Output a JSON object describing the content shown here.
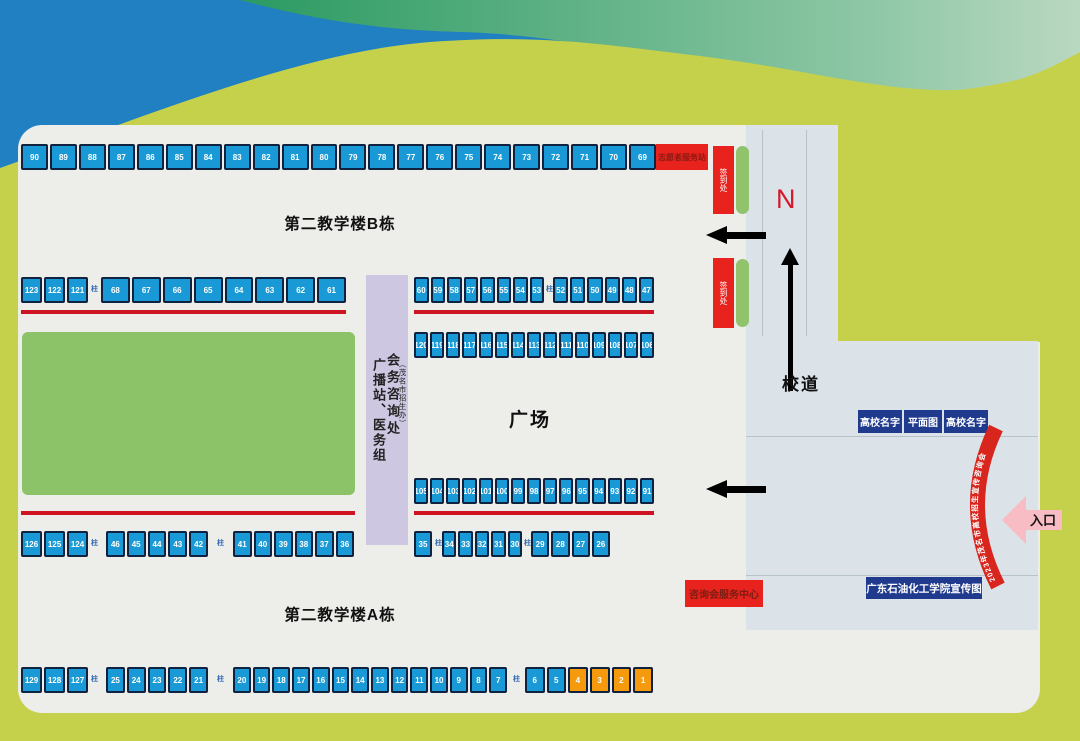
{
  "labels": {
    "building_b": "第二教学楼B栋",
    "building_a": "第二教学楼A栋",
    "plaza": "广场",
    "road": "校道",
    "north": "N",
    "volunteer_station": "志愿者服务站",
    "service_center": "咨询会服务中心",
    "entrance": "入口",
    "banner": "广东石油化工学院宣传图",
    "uni_name": "高校名字",
    "site_map": "平面图",
    "broadcast_medical": "广播站、医务组",
    "conference_info": "会务咨询处",
    "admissions_office": "（茂名市招生办）",
    "checkin": "签到处",
    "pillar": "柱",
    "arc_banner": "2023年茂名市高校招生宣传咨询会"
  },
  "booths": {
    "row_a": [
      90,
      89,
      88,
      87,
      86,
      85,
      84,
      83,
      82,
      81,
      80,
      79,
      78,
      77,
      76,
      75,
      74,
      73,
      72,
      71,
      70,
      69
    ],
    "row_b1": [
      123,
      122,
      121
    ],
    "row_b2": [
      68,
      67,
      66,
      65,
      64,
      63,
      62,
      61
    ],
    "row_b3": [
      60,
      59,
      58,
      57,
      56,
      55,
      54,
      53
    ],
    "row_b4": [
      52,
      51,
      50,
      49,
      48,
      47
    ],
    "row_c": [
      120,
      119,
      118,
      117,
      116,
      115,
      114,
      113,
      112,
      111,
      110,
      109,
      108,
      107,
      106
    ],
    "row_d": [
      105,
      104,
      103,
      102,
      101,
      100,
      99,
      98,
      97,
      96,
      95,
      94,
      93,
      92,
      91
    ],
    "row_e1": [
      126,
      125,
      124
    ],
    "row_e2": [
      46,
      45,
      44,
      43,
      42
    ],
    "row_e3": [
      41,
      40,
      39,
      38,
      37,
      36
    ],
    "row_e4": [
      35
    ],
    "row_e5": [
      34,
      33,
      32,
      31,
      30
    ],
    "row_e6": [
      29,
      28,
      27,
      26
    ],
    "row_f1": [
      129,
      128,
      127
    ],
    "row_f2": [
      25,
      24,
      23,
      22,
      21
    ],
    "row_f3": [
      20,
      19,
      18,
      17,
      16,
      15,
      14,
      13,
      12,
      11,
      10,
      9,
      8,
      7
    ],
    "row_f4": [
      6,
      5
    ],
    "row_f5": [
      4,
      3,
      2,
      1
    ]
  },
  "colors": {
    "background": "#c6d14b",
    "wave_blue": "#2080c2",
    "wave_green": "#2b9a62",
    "map_area": "#ededea",
    "road": "#dbe3e8",
    "booth_blue": "#1999d5",
    "booth_orange": "#f59a0c",
    "booth_border": "#0f2240",
    "red_accent": "#e8231d",
    "red_line": "#cf1421",
    "lawn_green": "#8cc268",
    "strip_purple": "#cdc7e1",
    "navy": "#203a8e",
    "entrance_pink": "#f8bcc4"
  }
}
